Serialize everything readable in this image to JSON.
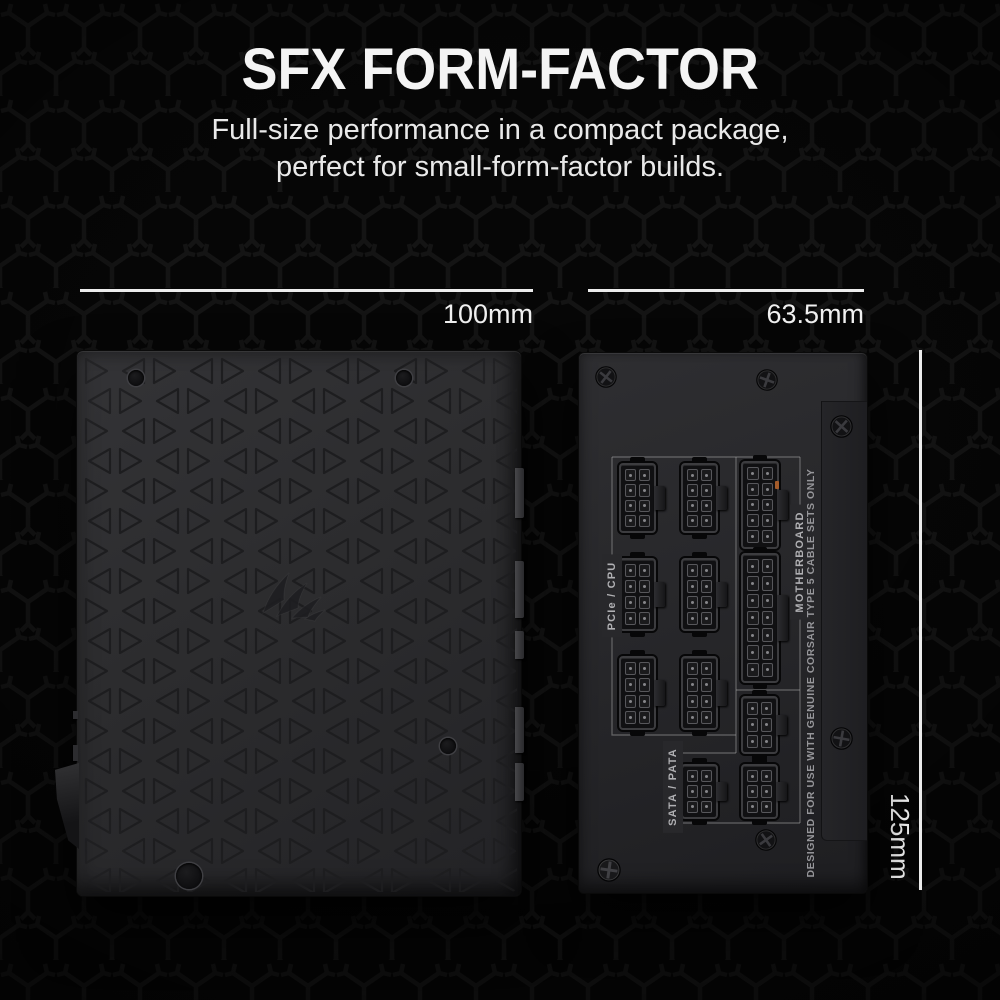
{
  "header": {
    "title": "SFX FORM-FACTOR",
    "subtitle_line1": "Full-size performance in a compact package,",
    "subtitle_line2": "perfect for small-form-factor builds."
  },
  "dimensions": {
    "width_label": "100mm",
    "depth_label": "63.5mm",
    "height_label": "125mm"
  },
  "psu_top": {
    "logo_icon": "corsair-sails-logo"
  },
  "psu_side": {
    "group_labels": {
      "pcie_cpu": "PCIe / CPU",
      "motherboard": "MOTHERBOARD",
      "sata_pata": "SATA / PATA"
    },
    "warning_text": "DESIGNED FOR USE WITH GENUINE CORSAIR TYPE 5 CABLE SETS ONLY",
    "connectors": [
      {
        "name": "pcie-cpu-8pin-1",
        "x": 40,
        "y": 110,
        "w": 37,
        "h": 70,
        "rows": 4,
        "cols": 2
      },
      {
        "name": "pcie-cpu-8pin-2",
        "x": 102,
        "y": 110,
        "w": 37,
        "h": 70,
        "rows": 4,
        "cols": 2
      },
      {
        "name": "pcie-cpu-8pin-3",
        "x": 40,
        "y": 205,
        "w": 37,
        "h": 73,
        "rows": 4,
        "cols": 2
      },
      {
        "name": "pcie-cpu-8pin-4",
        "x": 102,
        "y": 205,
        "w": 37,
        "h": 73,
        "rows": 4,
        "cols": 2
      },
      {
        "name": "pcie-cpu-8pin-5",
        "x": 40,
        "y": 303,
        "w": 37,
        "h": 74,
        "rows": 4,
        "cols": 2
      },
      {
        "name": "pcie-cpu-8pin-6",
        "x": 102,
        "y": 303,
        "w": 37,
        "h": 74,
        "rows": 4,
        "cols": 2
      },
      {
        "name": "motherboard-10pin",
        "x": 162,
        "y": 108,
        "w": 38,
        "h": 88,
        "rows": 5,
        "cols": 2,
        "glint": true
      },
      {
        "name": "motherboard-14pin",
        "x": 162,
        "y": 200,
        "w": 38,
        "h": 130,
        "rows": 7,
        "cols": 2
      },
      {
        "name": "motherboard-6pin",
        "x": 162,
        "y": 343,
        "w": 37,
        "h": 58,
        "rows": 3,
        "cols": 2
      },
      {
        "name": "sata-pata-6pin-1",
        "x": 102,
        "y": 411,
        "w": 37,
        "h": 55,
        "rows": 3,
        "cols": 2
      },
      {
        "name": "sata-pata-6pin-2",
        "x": 162,
        "y": 411,
        "w": 37,
        "h": 55,
        "rows": 3,
        "cols": 2
      }
    ]
  },
  "colors": {
    "background": "#060606",
    "pattern_stroke": "#161616",
    "text_primary": "#f4f4f4",
    "dimension_line": "#ececec",
    "psu_body": "#2b2b2d",
    "psu_label": "#b0b0b3"
  }
}
